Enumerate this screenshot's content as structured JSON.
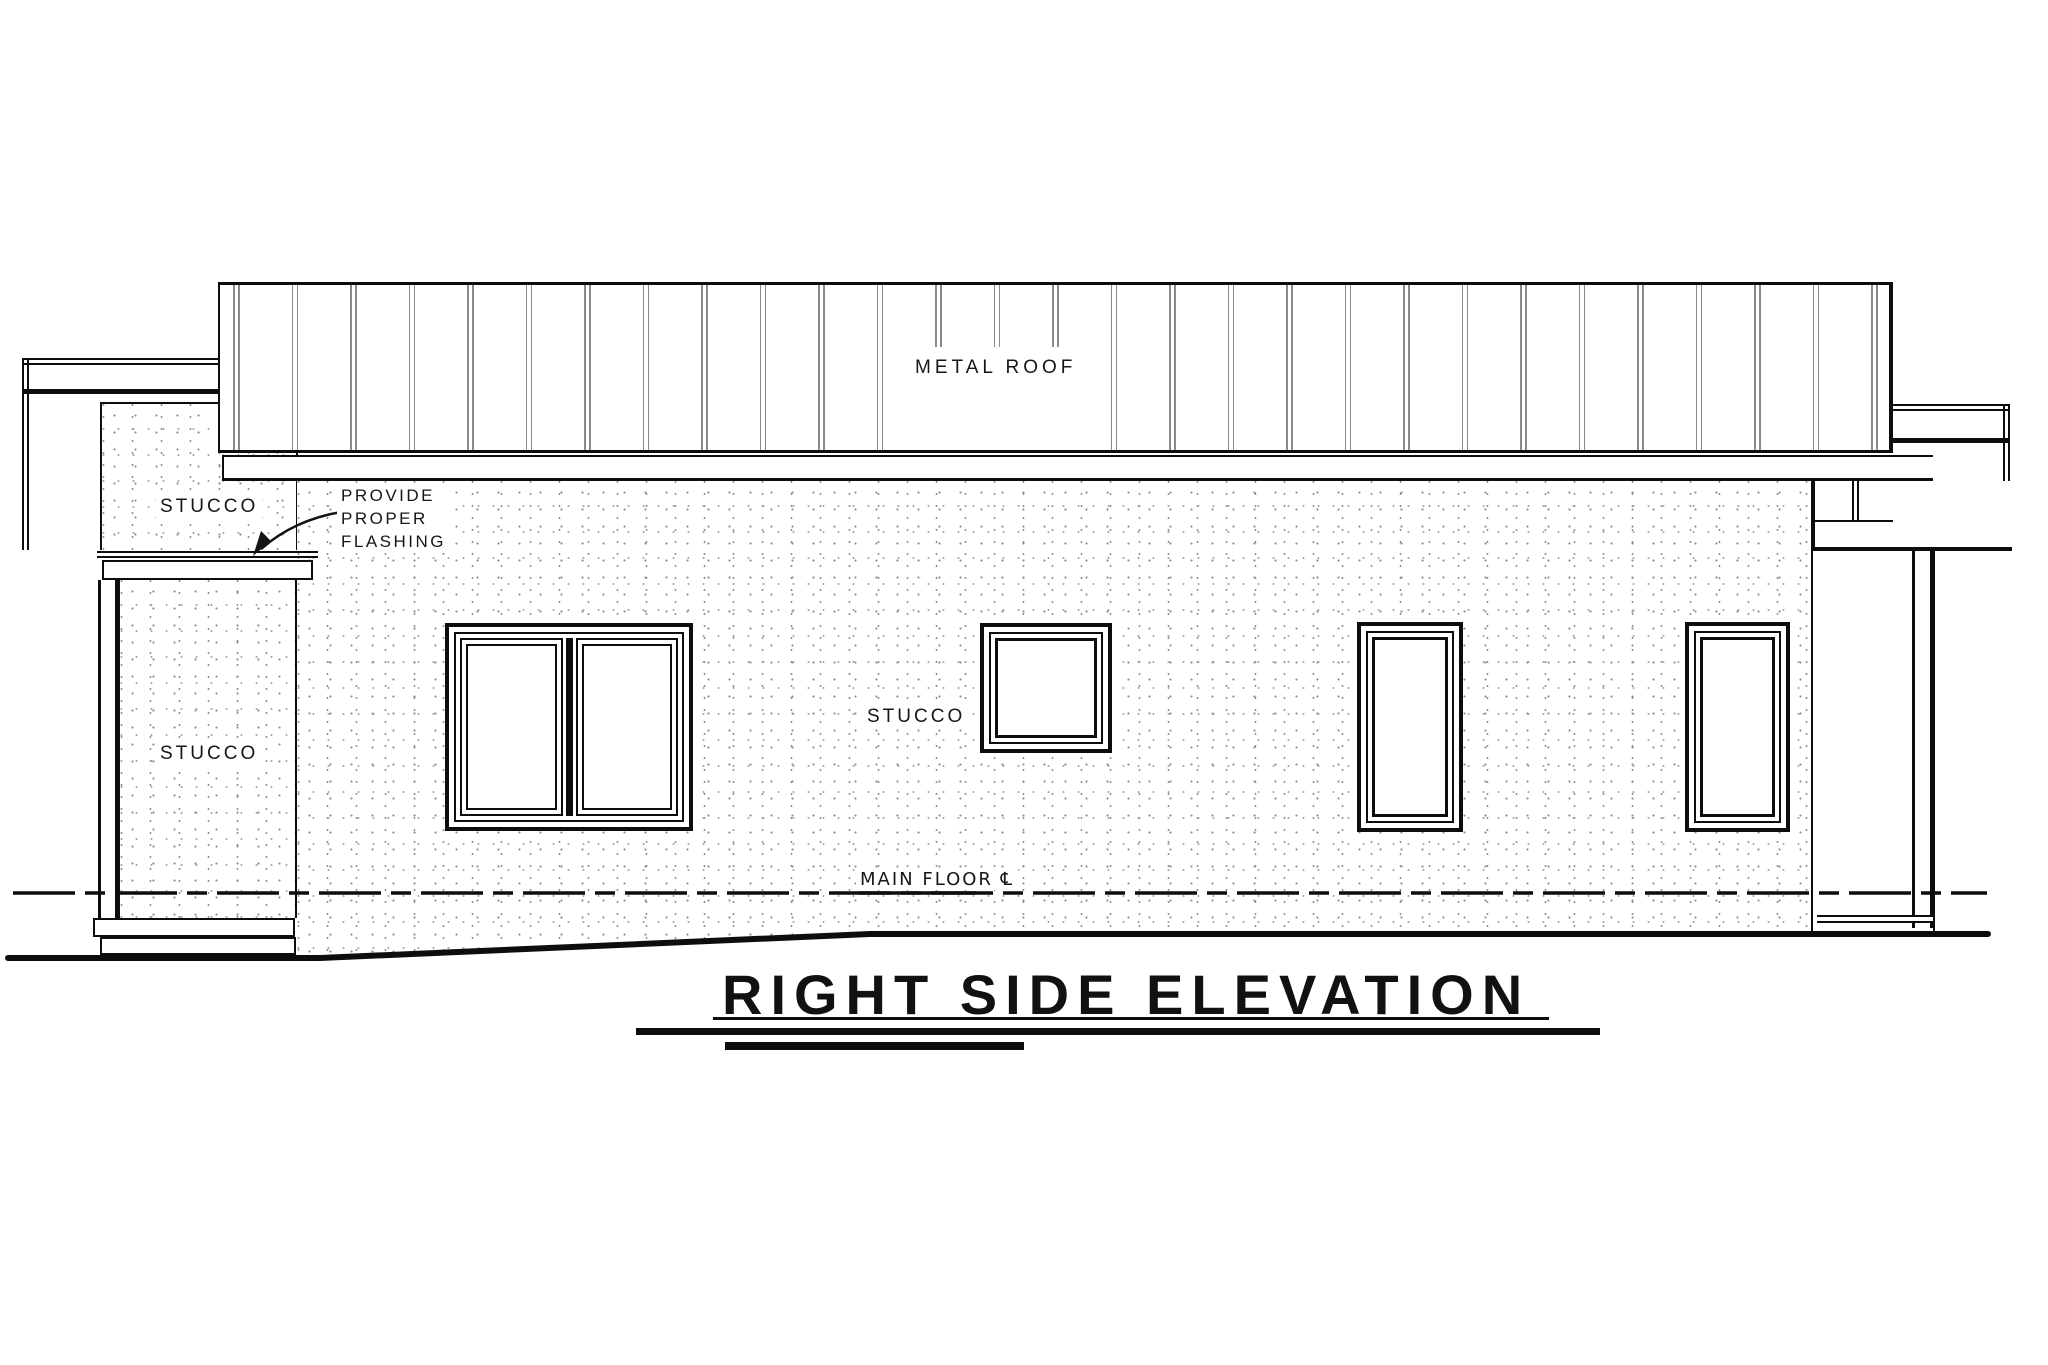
{
  "drawing": {
    "title": "RIGHT SIDE ELEVATION",
    "labels": {
      "roof_material": "METAL ROOF",
      "stucco_upper_left": "STUCCO",
      "stucco_lower_left": "STUCCO",
      "stucco_main_wall": "STUCCO",
      "flashing_note_line1": "PROVIDE",
      "flashing_note_line2": "PROPER",
      "flashing_note_line3": "FLASHING",
      "main_floor": "MAIN FLOOR ℄"
    },
    "colors": {
      "line": "#0d0d0d",
      "paper": "#ffffff",
      "stucco_dot": "#8f8f8f",
      "roof_seam": "#8a8a8a"
    }
  }
}
